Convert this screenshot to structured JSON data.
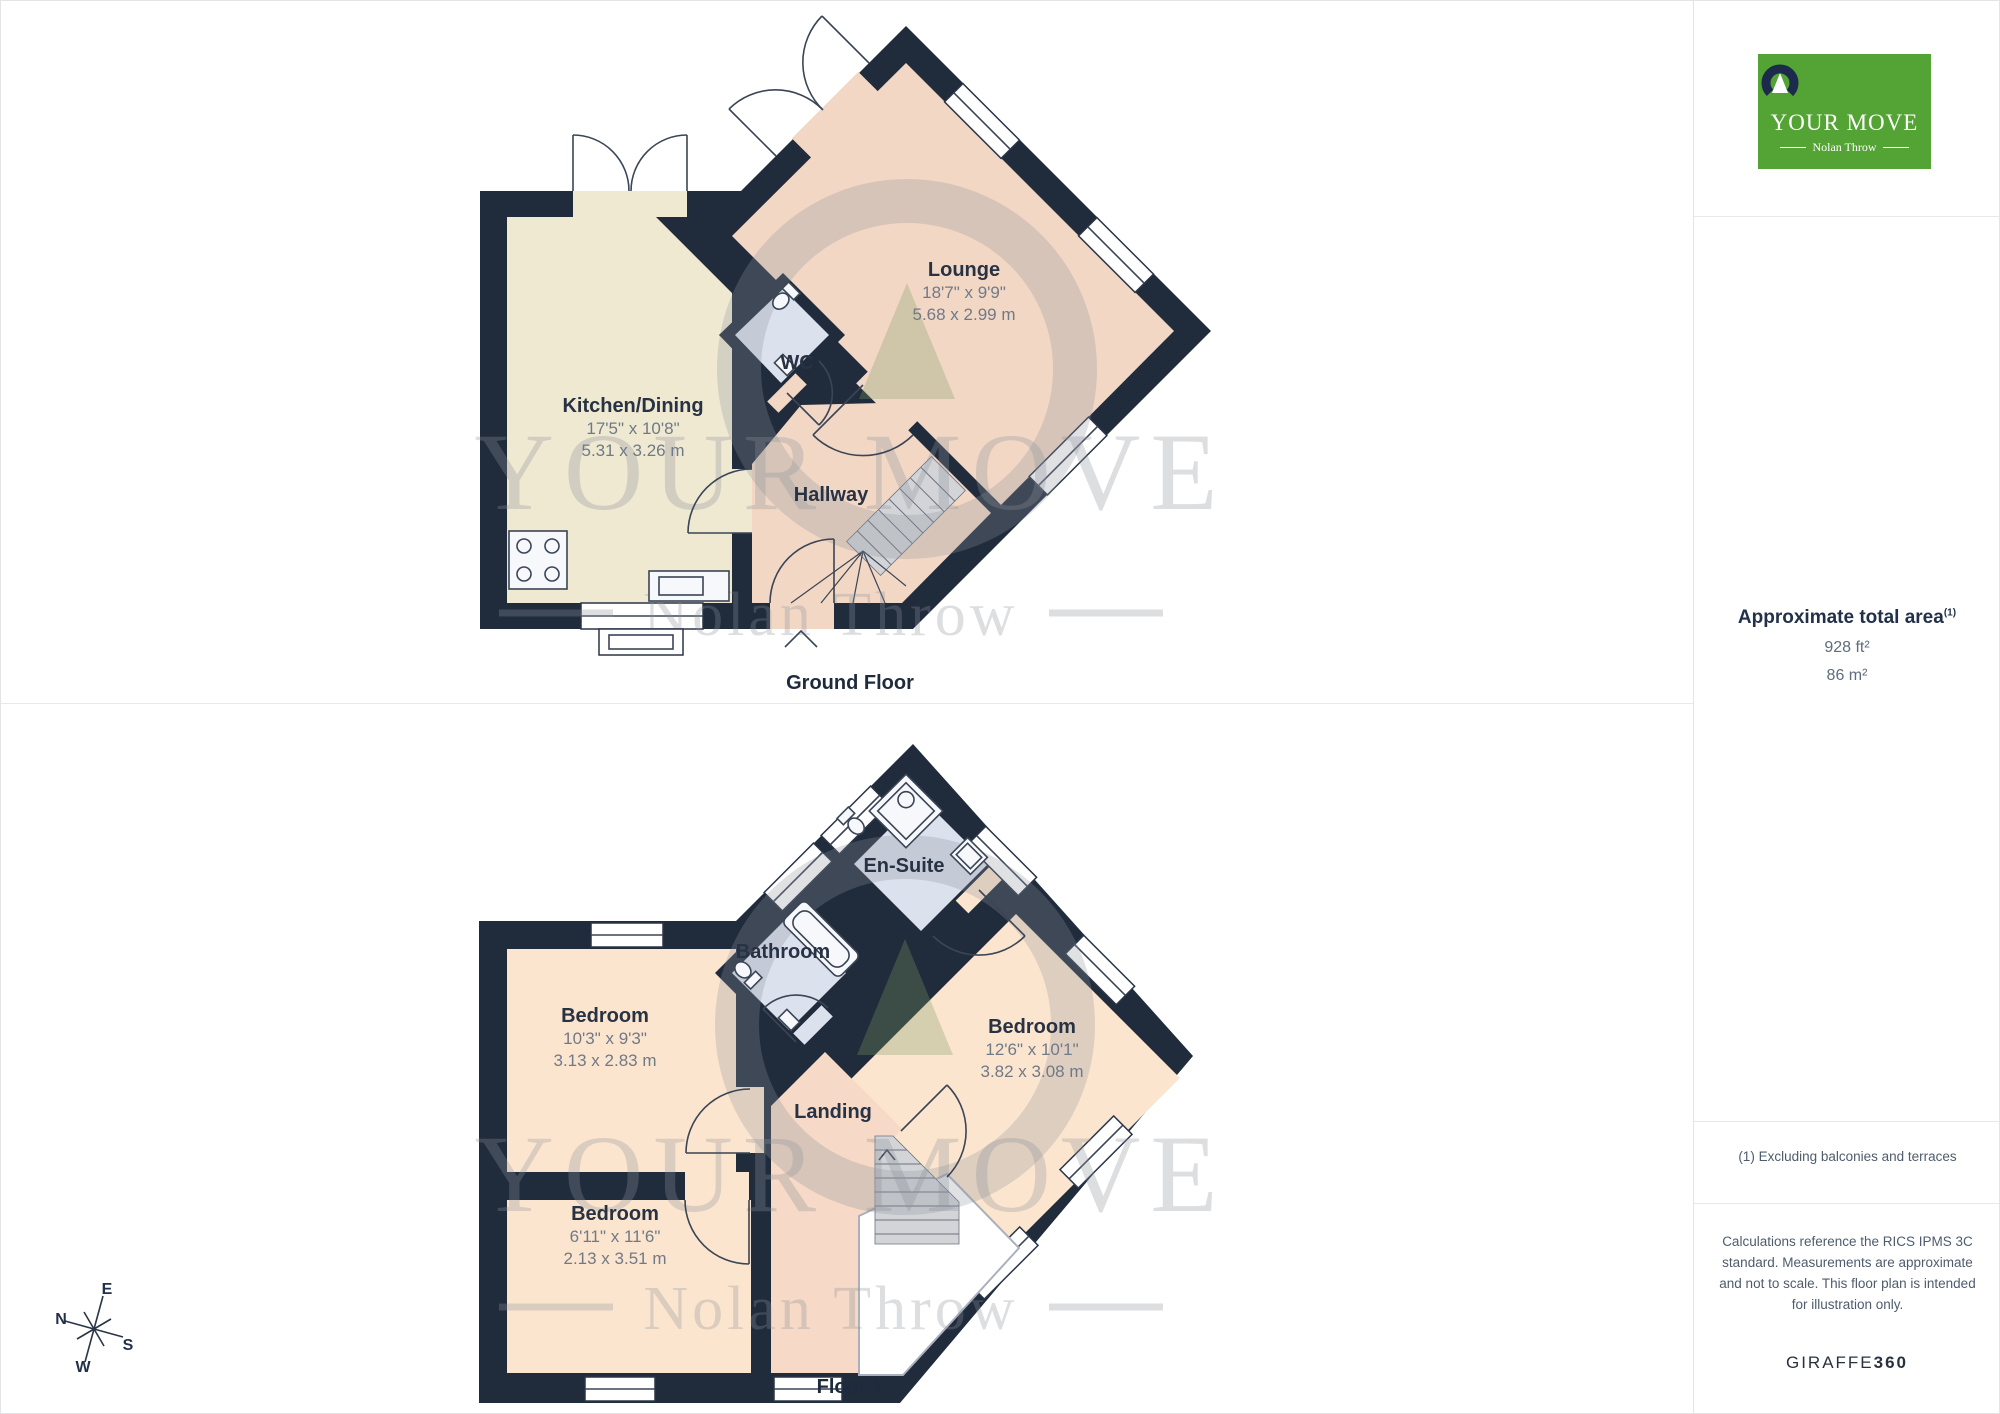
{
  "ground": {
    "label": "Ground Floor",
    "rooms": {
      "kitchen": {
        "name": "Kitchen/Dining",
        "imperial": "17'5\" x 10'8\"",
        "metric": "5.31 x 3.26 m"
      },
      "lounge": {
        "name": "Lounge",
        "imperial": "18'7\" x 9'9\"",
        "metric": "5.68 x 2.99 m"
      },
      "wc": {
        "name": "WC"
      },
      "hallway": {
        "name": "Hallway"
      }
    }
  },
  "floor1": {
    "label": "Floor 1",
    "rooms": {
      "bedroom1": {
        "name": "Bedroom",
        "imperial": "10'3\" x 9'3\"",
        "metric": "3.13 x 2.83 m"
      },
      "bedroom2": {
        "name": "Bedroom",
        "imperial": "12'6\" x 10'1\"",
        "metric": "3.82 x 3.08 m"
      },
      "bedroom3": {
        "name": "Bedroom",
        "imperial": "6'11\" x 11'6\"",
        "metric": "2.13 x 3.51 m"
      },
      "bathroom": {
        "name": "Bathroom"
      },
      "ensuite": {
        "name": "En-Suite"
      },
      "landing": {
        "name": "Landing"
      }
    }
  },
  "compass": {
    "n": "N",
    "e": "E",
    "s": "S",
    "w": "W"
  },
  "watermark": {
    "brand": "YOUR MOVE",
    "sub": "Nolan Throw"
  },
  "sidebar": {
    "logo": {
      "brand": "YOUR MOVE",
      "sub": "Nolan Throw"
    },
    "area": {
      "heading": "Approximate total area",
      "note_ref": "(1)",
      "imperial": "928 ft²",
      "metric": "86 m²"
    },
    "footnote": "(1) Excluding balconies and terraces",
    "disclaimer": "Calculations reference the RICS IPMS 3C standard. Measurements are approximate and not to scale. This floor plan is intended for illustration only.",
    "brand_name": "GIRAFFE",
    "brand_number": "360"
  },
  "colors": {
    "wall": "#202B3C",
    "kitchen": "#EFE9D2",
    "peach": "#F3D7C5",
    "bedroom_peach": "#FCE5CE",
    "landing_peach": "#F6D9C6",
    "wet_blue": "#DCE1EE",
    "stairs": "#D3D4D8",
    "logo_green": "#54A335",
    "logo_navy": "#1C2B4C",
    "text_navy": "#273244"
  }
}
